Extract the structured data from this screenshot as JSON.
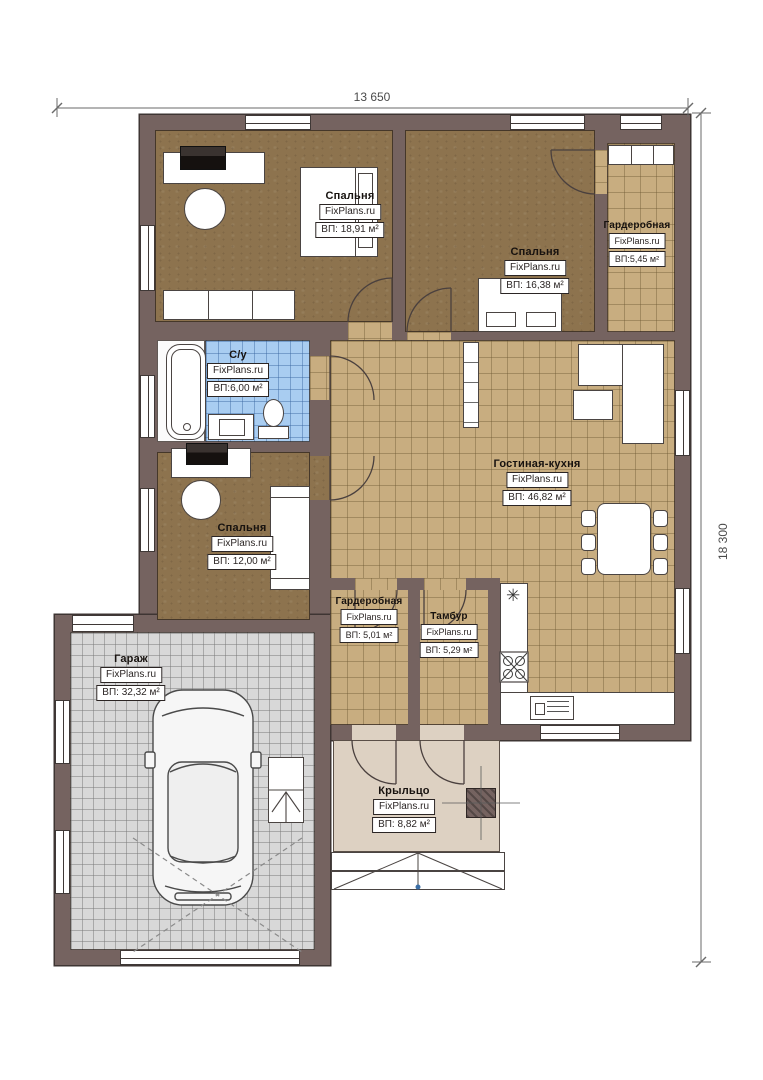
{
  "watermark": "FixPlans.ru",
  "dimensions": {
    "width": "13 650",
    "height": "18 300"
  },
  "rooms": [
    {
      "id": "bedroom-1",
      "name": "Спальня",
      "area": "ВП: 18,91 м²"
    },
    {
      "id": "bedroom-2",
      "name": "Спальня",
      "area": "ВП: 16,38 м²"
    },
    {
      "id": "wardrobe-1",
      "name": "Гардеробная",
      "area": "ВП:5,45 м²"
    },
    {
      "id": "bathroom",
      "name": "С/у",
      "area": "ВП:6,00 м²"
    },
    {
      "id": "bedroom-3",
      "name": "Спальня",
      "area": "ВП: 12,00 м²"
    },
    {
      "id": "living",
      "name": "Гостиная-кухня",
      "area": "ВП: 46,82 м²"
    },
    {
      "id": "wardrobe-2",
      "name": "Гардеробная",
      "area": "ВП: 5,01 м²"
    },
    {
      "id": "tambur",
      "name": "Тамбур",
      "area": "ВП: 5,29 м²"
    },
    {
      "id": "garage",
      "name": "Гараж",
      "area": "ВП: 32,32 м²"
    },
    {
      "id": "porch",
      "name": "Крыльцо",
      "area": "ВП: 8,82 м²"
    }
  ],
  "colors": {
    "wall": "#756360",
    "parquet": "#8d734e",
    "tile_tan": "#c8ad80",
    "tile_blue": "#a9cdf1",
    "tile_gray": "#d8d8d8",
    "porch": "#ddd1c2"
  }
}
